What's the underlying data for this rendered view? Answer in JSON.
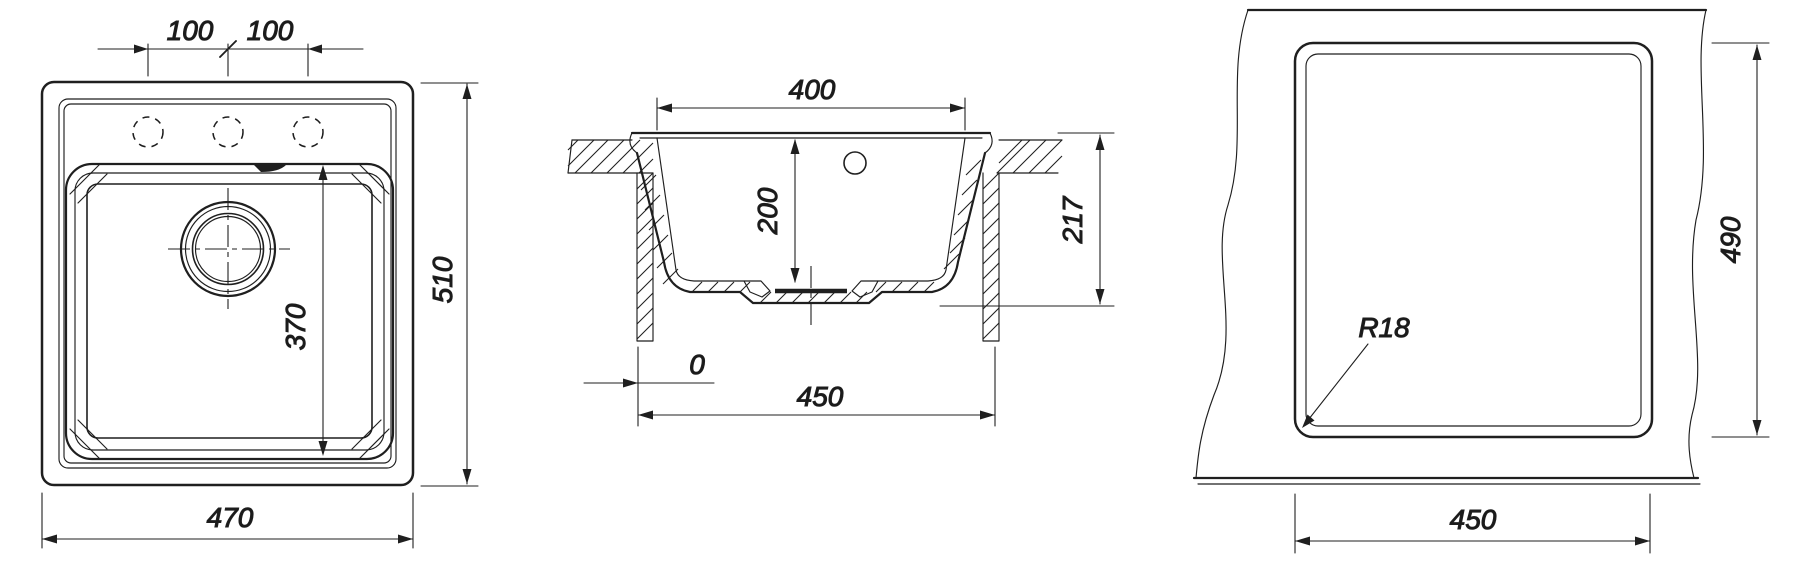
{
  "drawing": {
    "title": "Kitchen sink dimensional drawing",
    "line_color": "#1f1f1f",
    "text_color": "#1a1a1a",
    "background": "#ffffff",
    "views": {
      "top": {
        "name": "top-view",
        "dims": {
          "hole_pitch_left": "100",
          "hole_pitch_right": "100",
          "bowl_length": "370",
          "overall_width": "470",
          "overall_depth": "510"
        }
      },
      "section": {
        "name": "cross-section-view",
        "dims": {
          "bowl_top_width": "400",
          "bowl_depth": "200",
          "overall_height": "217",
          "edge_offset": "0",
          "bottom_width": "450"
        }
      },
      "cutout": {
        "name": "worktop-cutout-view",
        "dims": {
          "cutout_width": "450",
          "cutout_height": "490",
          "corner_radius": "R18"
        }
      }
    }
  }
}
